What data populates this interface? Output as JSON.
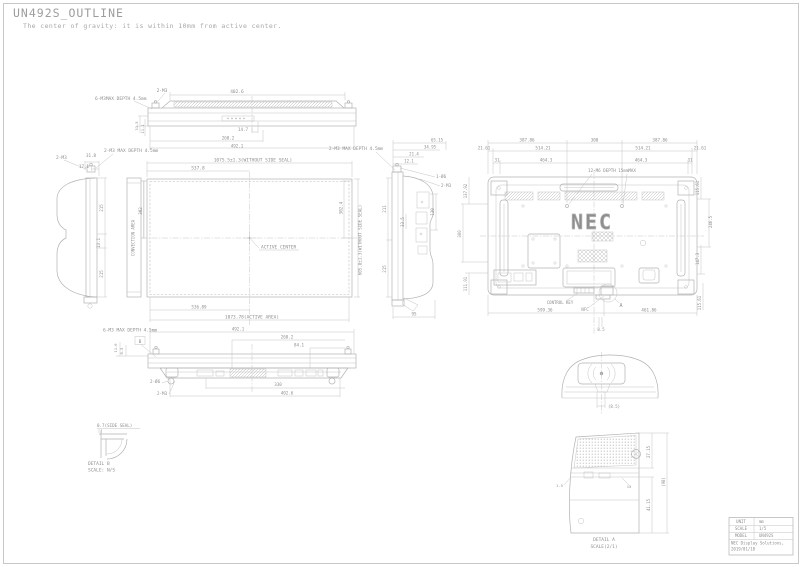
{
  "page": {
    "title": "UN492S_OUTLINE",
    "subtitle": "The center of gravity: it is within 10mm from active center."
  },
  "views": {
    "top_view": {
      "labels": [
        {
          "t": "6-M3MAX DEPTH 4.5mm",
          "x": 95,
          "y": 100,
          "a": "start",
          "s": 4.5
        },
        {
          "t": "2-M3",
          "x": 162,
          "y": 92,
          "s": 4.5
        },
        {
          "t": "402.6",
          "x": 237,
          "y": 93,
          "s": 4.5
        },
        {
          "t": "14.7",
          "x": 243,
          "y": 131,
          "s": 4.2
        },
        {
          "t": "268.2",
          "x": 228,
          "y": 139.5,
          "s": 4.2
        },
        {
          "t": "492.1",
          "x": 237,
          "y": 147.5,
          "s": 4.2
        },
        {
          "t": "31.5",
          "x": 138,
          "y": 126,
          "r": -90,
          "s": 3.8
        },
        {
          "t": "11.1",
          "x": 144,
          "y": 129,
          "r": -90,
          "s": 3.8
        }
      ]
    },
    "side_view_left": {
      "labels": [
        {
          "t": "2-M3",
          "x": 56,
          "y": 159,
          "a": "start",
          "s": 4.5
        },
        {
          "t": "31.8",
          "x": 91,
          "y": 157,
          "s": 4.2
        },
        {
          "t": "17.1",
          "x": 84,
          "y": 168,
          "s": 4.2
        },
        {
          "t": "2-M3 MAX DEPTH 4.5mm",
          "x": 104,
          "y": 152,
          "a": "start",
          "s": 4.5
        },
        {
          "t": "215",
          "x": 103,
          "y": 208,
          "r": -90,
          "s": 4.2
        },
        {
          "t": "13.1",
          "x": 100,
          "y": 243,
          "r": -90,
          "s": 4.2
        },
        {
          "t": "215",
          "x": 103,
          "y": 274,
          "r": -90,
          "s": 4.2
        },
        {
          "t": "CONVECTION AREA",
          "x": 134.5,
          "y": 238,
          "r": -90,
          "s": 4
        },
        {
          "t": "302",
          "x": 142,
          "y": 211,
          "r": -90,
          "s": 4.2
        }
      ]
    },
    "front_view": {
      "labels": [
        {
          "t": "537.8",
          "x": 198,
          "y": 169.5,
          "s": 4.5
        },
        {
          "t": "1075.5±1.3(WITHOUT SIDE SEAL)",
          "x": 253,
          "y": 161.5,
          "s": 4.5
        },
        {
          "t": "ACTIVE CENTER",
          "x": 261,
          "y": 248.5,
          "a": "start",
          "s": 4.5
        },
        {
          "t": "302.4",
          "x": 342.5,
          "y": 208,
          "r": -90,
          "s": 4.2
        },
        {
          "t": "605.8±1.3(WITHOUT SIDE SEAL)",
          "x": 361.5,
          "y": 240,
          "r": -90,
          "s": 4.2
        },
        {
          "t": "536.89",
          "x": 199,
          "y": 308.5,
          "s": 4.2
        },
        {
          "t": "1073.78(ACTIVE AREA)",
          "x": 252,
          "y": 318.5,
          "s": 4.5
        },
        {
          "t": "2-M3 MAX DEPTH 4.5mm",
          "x": 356,
          "y": 150,
          "s": 4.5
        }
      ]
    },
    "side_view_right": {
      "labels": [
        {
          "t": "65.15",
          "x": 437,
          "y": 141.5,
          "s": 4
        },
        {
          "t": "34.95",
          "x": 430,
          "y": 148.5,
          "s": 4
        },
        {
          "t": "21.4",
          "x": 414,
          "y": 155.5,
          "s": 4
        },
        {
          "t": "12.1",
          "x": 409,
          "y": 162.5,
          "s": 4
        },
        {
          "t": "1-Ø6",
          "x": 436,
          "y": 178,
          "a": "start",
          "s": 4.2
        },
        {
          "t": "2-M3",
          "x": 441,
          "y": 187,
          "a": "start",
          "s": 4.2
        },
        {
          "t": "211",
          "x": 386,
          "y": 209,
          "r": -90,
          "s": 4.2
        },
        {
          "t": "33.5",
          "x": 404,
          "y": 222,
          "r": -90,
          "s": 4
        },
        {
          "t": "130",
          "x": 434,
          "y": 212,
          "r": -90,
          "s": 4.2
        },
        {
          "t": "215",
          "x": 386,
          "y": 269,
          "r": -90,
          "s": 4.2
        },
        {
          "t": "95",
          "x": 414,
          "y": 315.5,
          "s": 4.2
        }
      ]
    },
    "rear_view": {
      "labels": [
        {
          "t": "387.86",
          "x": 527,
          "y": 141.5,
          "s": 4.2
        },
        {
          "t": "300",
          "x": 594.5,
          "y": 141.5,
          "s": 4.2
        },
        {
          "t": "387.86",
          "x": 660,
          "y": 141.5,
          "s": 4.2
        },
        {
          "t": "21.61",
          "x": 484,
          "y": 149.5,
          "s": 4.2
        },
        {
          "t": "514.21",
          "x": 543,
          "y": 149.5,
          "s": 4.2
        },
        {
          "t": "514.21",
          "x": 643,
          "y": 149.5,
          "s": 4.2
        },
        {
          "t": "21.61",
          "x": 700,
          "y": 149.5,
          "s": 4.2
        },
        {
          "t": "31",
          "x": 497,
          "y": 161.5,
          "s": 4.2
        },
        {
          "t": "464.3",
          "x": 546,
          "y": 161.5,
          "s": 4.2
        },
        {
          "t": "464.3",
          "x": 641,
          "y": 161.5,
          "s": 4.2
        },
        {
          "t": "31",
          "x": 690,
          "y": 161.5,
          "s": 4.2
        },
        {
          "t": "12-M6 DEPTH 15mmMAX",
          "x": 612,
          "y": 172,
          "s": 4.2
        },
        {
          "t": "137.92",
          "x": 467,
          "y": 191,
          "r": -90,
          "s": 4
        },
        {
          "t": "300",
          "x": 461,
          "y": 234,
          "r": -90,
          "s": 4
        },
        {
          "t": "111.91",
          "x": 467,
          "y": 284,
          "r": -90,
          "s": 4
        },
        {
          "t": "115.61",
          "x": 699,
          "y": 188,
          "r": -90,
          "s": 4
        },
        {
          "t": "246.5",
          "x": 712,
          "y": 222,
          "r": -90,
          "s": 4
        },
        {
          "t": "147.3",
          "x": 699,
          "y": 259,
          "r": -90,
          "s": 4
        },
        {
          "t": "115.61",
          "x": 701,
          "y": 303,
          "r": -90,
          "s": 4
        },
        {
          "t": "599.36",
          "x": 545,
          "y": 311.5,
          "s": 4.2
        },
        {
          "t": "461.86",
          "x": 649,
          "y": 311.5,
          "s": 4.2
        },
        {
          "t": "8.5",
          "x": 601,
          "y": 331,
          "s": 4
        },
        {
          "t": "CONTROL KEY",
          "x": 560,
          "y": 304,
          "s": 4
        },
        {
          "t": "NFC",
          "x": 585,
          "y": 311,
          "s": 4
        },
        {
          "t": "A",
          "x": 621,
          "y": 307,
          "s": 5,
          "n": "detail-a-marker"
        },
        {
          "t": "NEC",
          "x": 592,
          "y": 229,
          "s": 20,
          "o": true,
          "ls": 2,
          "n": "nec-logo"
        }
      ]
    },
    "bottom_view": {
      "labels": [
        {
          "t": "6-M3 MAX DEPTH 4.5mm",
          "x": 103,
          "y": 331.5,
          "a": "start",
          "s": 4.5
        },
        {
          "t": "492.1",
          "x": 238,
          "y": 330.5,
          "s": 4.2
        },
        {
          "t": "268.2",
          "x": 287,
          "y": 338.5,
          "s": 4.2
        },
        {
          "t": "84.1",
          "x": 299,
          "y": 346.5,
          "s": 4.2
        },
        {
          "t": "11.6",
          "x": 117,
          "y": 348,
          "r": -90,
          "s": 3.8
        },
        {
          "t": "8.5",
          "x": 123,
          "y": 351,
          "r": -90,
          "s": 3.8
        },
        {
          "t": "B",
          "x": 140,
          "y": 343,
          "s": 4.5,
          "n": "detail-b-marker"
        },
        {
          "t": "2-Ø6",
          "x": 150,
          "y": 383,
          "a": "start",
          "s": 4.2
        },
        {
          "t": "2-M3",
          "x": 157,
          "y": 395,
          "a": "start",
          "s": 4.2
        },
        {
          "t": "330",
          "x": 278,
          "y": 386,
          "s": 4.2
        },
        {
          "t": "402.6",
          "x": 287,
          "y": 394.5,
          "s": 4.2
        }
      ]
    },
    "detail_b": {
      "labels": [
        {
          "t": "0.7(SIDE SEAL)",
          "x": 97,
          "y": 427,
          "a": "start",
          "s": 4.2
        },
        {
          "t": "DETAIL B",
          "x": 88,
          "y": 465,
          "a": "start",
          "s": 4.5
        },
        {
          "t": "SCALE: N/S",
          "x": 88,
          "y": 471.5,
          "a": "start",
          "s": 4.5
        }
      ]
    },
    "nfc_module_top": {
      "labels": [
        {
          "t": "(8.5)",
          "x": 608,
          "y": 408,
          "a": "start",
          "s": 4
        }
      ]
    },
    "detail_a": {
      "labels": [
        {
          "t": "27.15",
          "x": 650,
          "y": 452,
          "r": -90,
          "s": 4
        },
        {
          "t": "(98)",
          "x": 665,
          "y": 482,
          "r": -90,
          "s": 4
        },
        {
          "t": "41.15",
          "x": 650,
          "y": 505,
          "r": -90,
          "s": 4
        },
        {
          "t": "1.5",
          "x": 556,
          "y": 487,
          "a": "start",
          "s": 3.8
        },
        {
          "t": "15",
          "x": 629,
          "y": 488,
          "s": 3.8
        },
        {
          "t": "DETAIL A",
          "x": 604,
          "y": 541,
          "s": 4.5
        },
        {
          "t": "SCALE(2/1)",
          "x": 604,
          "y": 548,
          "s": 4.5
        }
      ]
    },
    "title_block": {
      "labels": [
        {
          "t": "UNIT",
          "x": 741,
          "y": 523,
          "s": 4,
          "n": "unit-label"
        },
        {
          "t": "mm",
          "x": 759,
          "y": 523,
          "s": 4,
          "a": "start",
          "n": "unit-value"
        },
        {
          "t": "SCALE",
          "x": 741,
          "y": 530,
          "s": 4,
          "n": "scale-label"
        },
        {
          "t": "1/5",
          "x": 759,
          "y": 530,
          "s": 4,
          "a": "start",
          "n": "scale-value"
        },
        {
          "t": "MODEL",
          "x": 741,
          "y": 537,
          "s": 4,
          "n": "model-label"
        },
        {
          "t": "UN492S",
          "x": 759,
          "y": 537,
          "s": 4,
          "a": "start",
          "n": "model-value"
        },
        {
          "t": "NEC Display Solutions,",
          "x": 731,
          "y": 544.5,
          "s": 4,
          "a": "start",
          "n": "company-name"
        },
        {
          "t": "2019/01/18",
          "x": 731,
          "y": 550.5,
          "s": 4,
          "a": "start",
          "n": "drawing-date"
        }
      ]
    }
  }
}
